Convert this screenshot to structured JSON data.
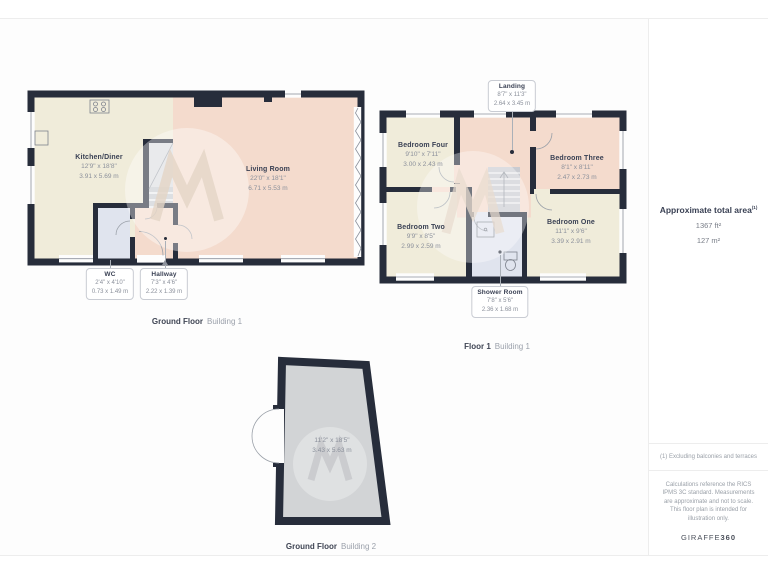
{
  "sidebar": {
    "area_title": "Approximate total area",
    "area_sup": "(1)",
    "area_ft": "1367 ft²",
    "area_m": "127 m²",
    "note_excluding": "(1) Excluding balconies and terraces",
    "note_disclaimer": "Calculations reference the RICS IPMS 3C standard. Measurements are approximate and not to scale. This floor plan is intended for illustration only.",
    "brand_name": "GIRAFFE",
    "brand_suffix": "360"
  },
  "plans": {
    "ground_floor_b1": {
      "caption_floor": "Ground Floor",
      "caption_building": "Building 1",
      "rooms": {
        "kitchen_diner": {
          "name": "Kitchen/Diner",
          "imperial": "12'9\" x 18'8\"",
          "metric": "3.91 x 5.69 m"
        },
        "living_room": {
          "name": "Living Room",
          "imperial": "22'0\" x 18'1\"",
          "metric": "6.71 x 5.53 m"
        },
        "wc": {
          "name": "WC",
          "imperial": "2'4\" x 4'10\"",
          "metric": "0.73 x 1.49 m"
        },
        "hallway": {
          "name": "Hallway",
          "imperial": "7'3\" x 4'6\"",
          "metric": "2.22 x 1.39 m"
        }
      }
    },
    "floor1_b1": {
      "caption_floor": "Floor 1",
      "caption_building": "Building 1",
      "rooms": {
        "landing": {
          "name": "Landing",
          "imperial": "8'7\" x 11'3\"",
          "metric": "2.64 x 3.45 m"
        },
        "bedroom_four": {
          "name": "Bedroom Four",
          "imperial": "9'10\" x 7'11\"",
          "metric": "3.00 x 2.43 m"
        },
        "bedroom_three": {
          "name": "Bedroom Three",
          "imperial": "8'1\" x 8'11\"",
          "metric": "2.47 x 2.73 m"
        },
        "bedroom_two": {
          "name": "Bedroom Two",
          "imperial": "9'9\" x 8'5\"",
          "metric": "2.99 x 2.59 m"
        },
        "bedroom_one": {
          "name": "Bedroom One",
          "imperial": "11'1\" x 9'6\"",
          "metric": "3.39 x 2.91 m"
        },
        "shower_room": {
          "name": "Shower Room",
          "imperial": "7'8\" x 5'6\"",
          "metric": "2.36 x 1.68 m"
        }
      }
    },
    "ground_floor_b2": {
      "caption_floor": "Ground Floor",
      "caption_building": "Building 2",
      "rooms": {
        "garage": {
          "imperial": "11'2\" x 18'5\"",
          "metric": "3.43 x 5.63 m"
        }
      }
    }
  },
  "colors": {
    "wall": "#272d3b",
    "room_cream": "#f0ecda",
    "room_pink": "#f4dbcd",
    "room_blue": "#e0e4ee",
    "room_gray": "#d2d4d6",
    "text_dark": "#3a4154",
    "text_muted": "#8b909b"
  }
}
